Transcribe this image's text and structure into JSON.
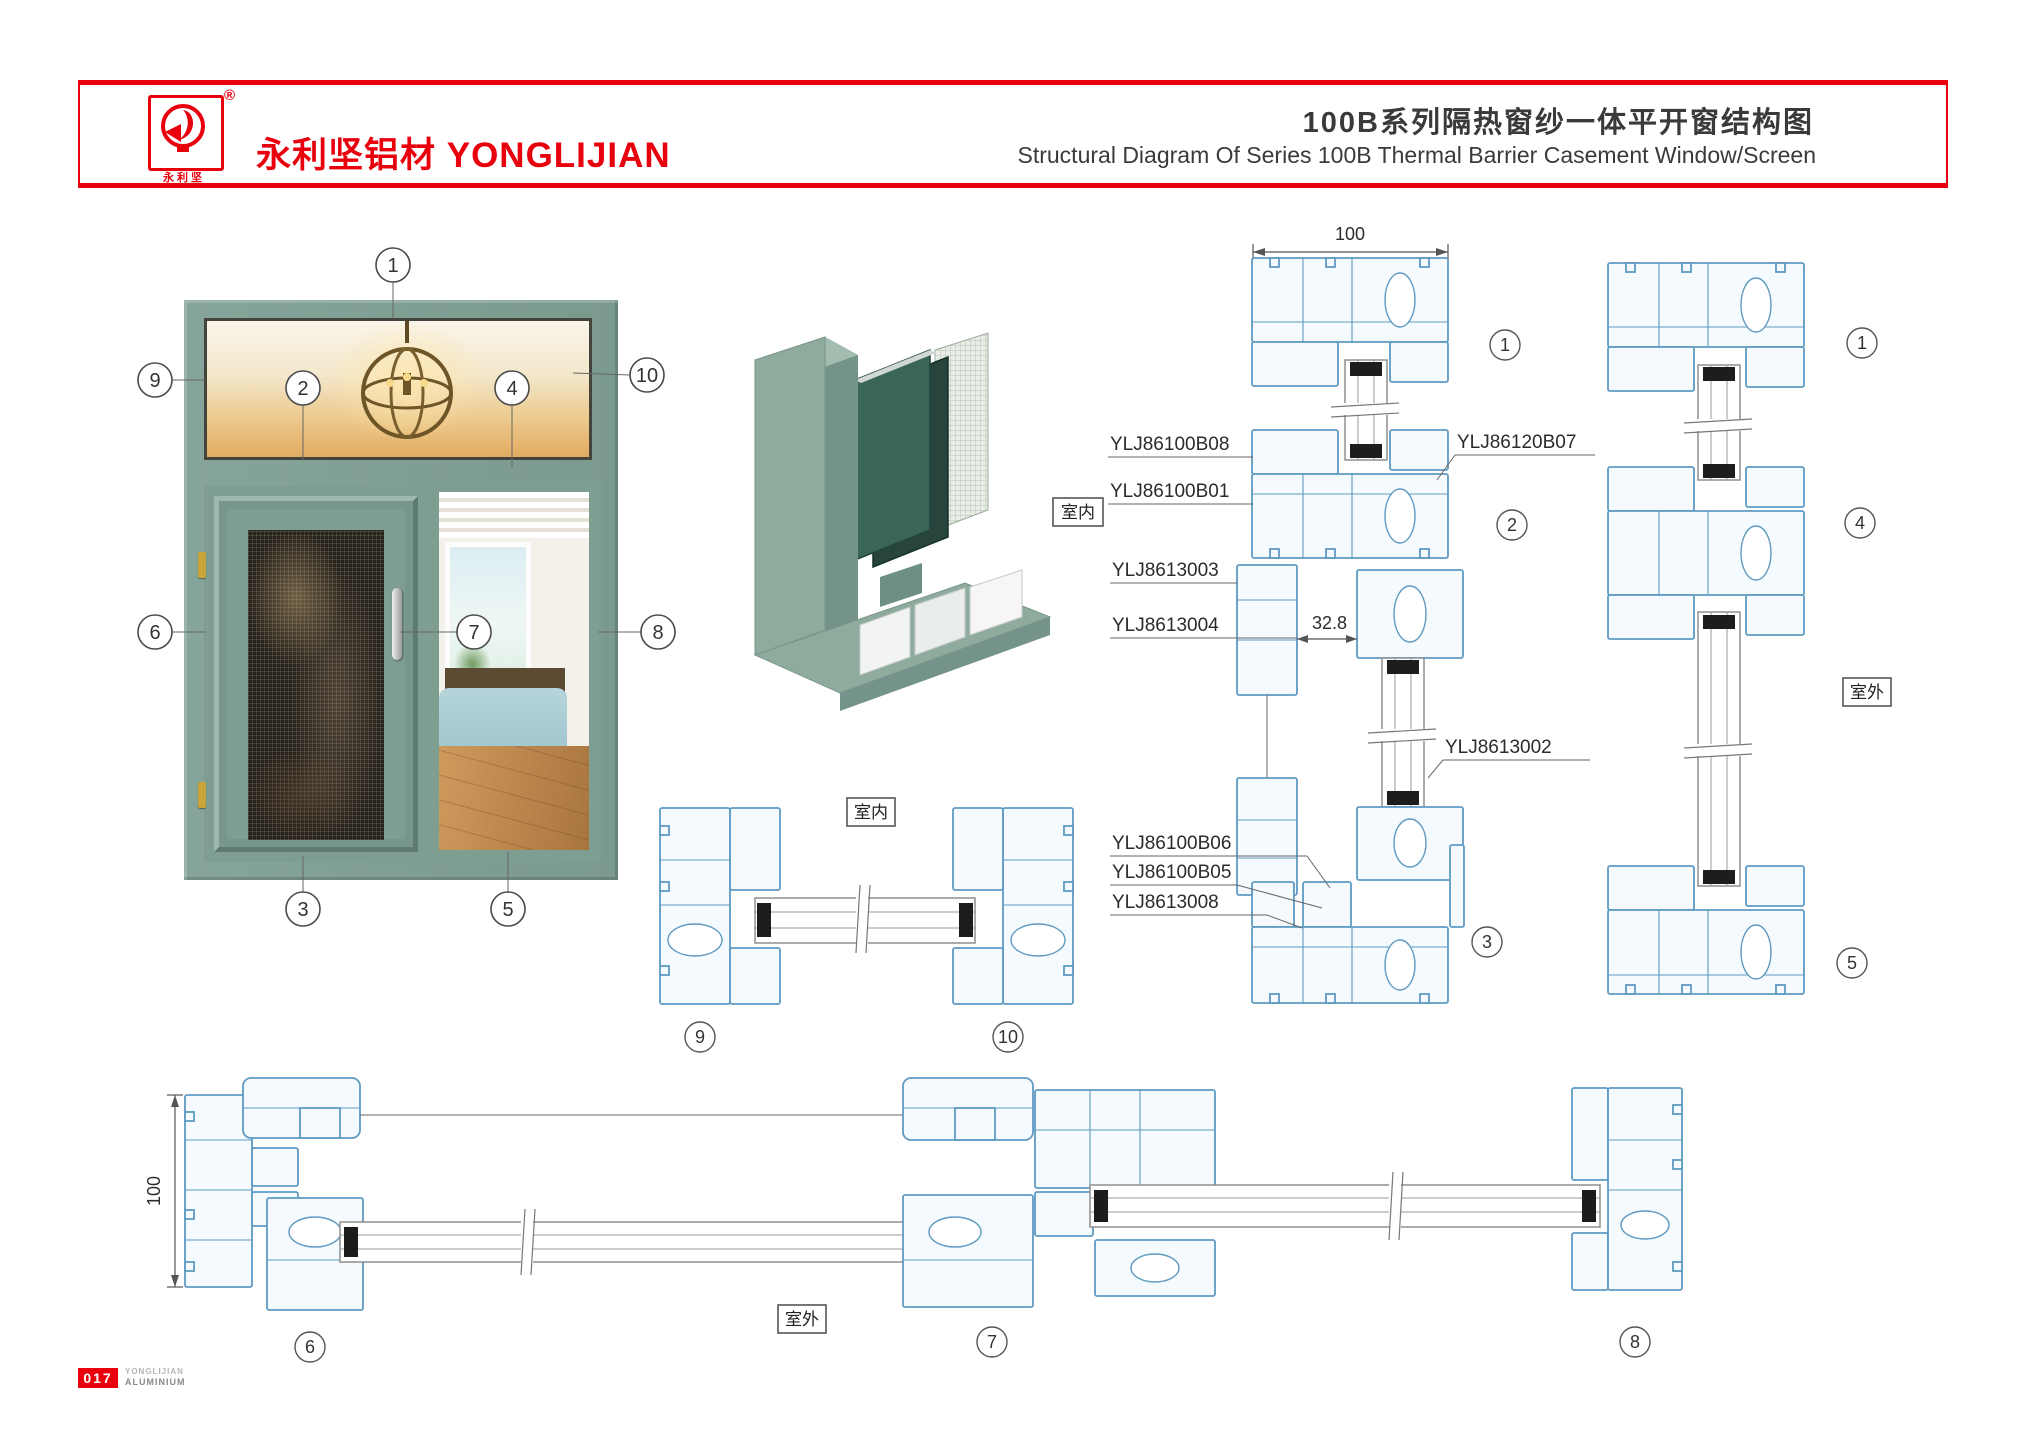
{
  "header": {
    "brand": "永利坚铝材 YONGLIJIAN",
    "logo_chars": "永利坚",
    "registered": "®",
    "title_cn": "100B系列隔热窗纱一体平开窗结构图",
    "title_en": "Structural Diagram Of Series 100B Thermal Barrier Casement Window/Screen"
  },
  "footer": {
    "page": "017",
    "line1": "YONGLIJIAN",
    "line2": "ALUMINIUM"
  },
  "rooms": {
    "indoor": "室内",
    "outdoor": "室外"
  },
  "dims": {
    "top_width": "100",
    "screen_gap": "32.8",
    "left_height": "100"
  },
  "labels": {
    "b08": "YLJ86100B08",
    "b01": "YLJ86100B01",
    "l3003": "YLJ8613003",
    "l3004": "YLJ8613004",
    "b07": "YLJ86120B07",
    "l3002": "YLJ8613002",
    "b06": "YLJ86100B06",
    "b05": "YLJ86100B05",
    "l3008": "YLJ8613008"
  },
  "callouts": {
    "c1": "1",
    "c2": "2",
    "c3": "3",
    "c4": "4",
    "c5": "5",
    "c6": "6",
    "c7": "7",
    "c8": "8",
    "c9": "9",
    "c10": "10"
  },
  "colors": {
    "accent_red": "#e8000d",
    "cad_blue": "#5f9ac2",
    "window_green": "#7e9e92"
  }
}
